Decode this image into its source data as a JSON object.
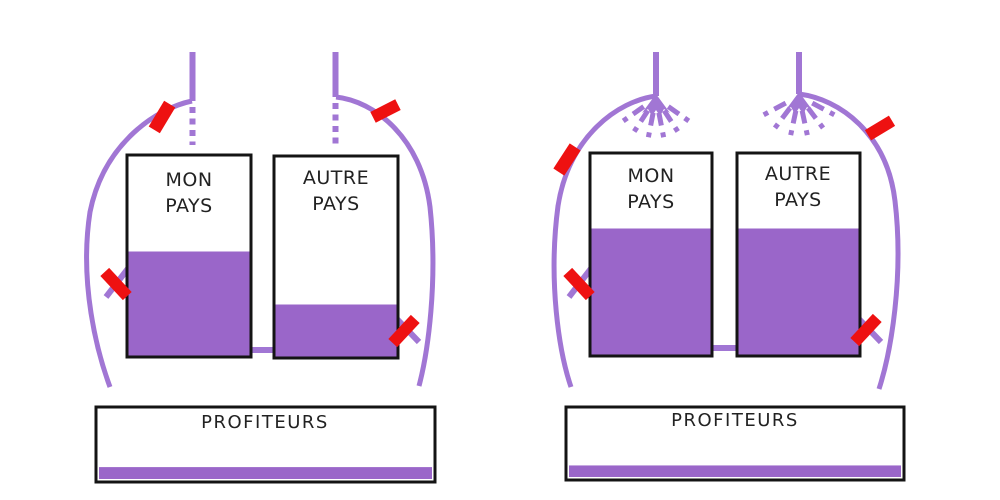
{
  "colors": {
    "purple_fill": "#9a66c9",
    "purple_line": "#a176d4",
    "red": "#ee1111",
    "box_border": "#141414",
    "text": "#222222",
    "background": "#ffffff"
  },
  "panels": [
    {
      "tanks": [
        {
          "label": [
            "MON",
            "PAYS"
          ],
          "fill_percent": 52
        },
        {
          "label": [
            "AUTRE",
            "PAYS"
          ],
          "fill_percent": 26
        }
      ],
      "reservoir": {
        "label": "PROFITEURS",
        "fill_percent": 17
      },
      "inflow_state": "blocked-dotted",
      "cut_marks": 4
    },
    {
      "tanks": [
        {
          "label": [
            "MON",
            "PAYS"
          ],
          "fill_percent": 63
        },
        {
          "label": [
            "AUTRE",
            "PAYS"
          ],
          "fill_percent": 63
        }
      ],
      "reservoir": {
        "label": "PROFITEURS",
        "fill_percent": 17
      },
      "inflow_state": "spraying",
      "cut_marks": 4
    }
  ]
}
